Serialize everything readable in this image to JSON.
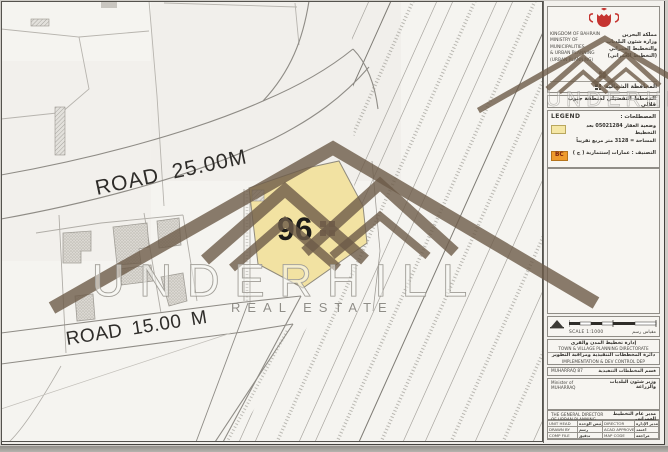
{
  "watermark": {
    "brand": "UNDERHILL",
    "tagline": "REAL ESTATE"
  },
  "map": {
    "plot_number": "96",
    "road_label_1": "ROAD 25.00M",
    "road_label_2": "ROAD 15.00 M"
  },
  "panel": {
    "header": {
      "en": [
        "KINGDOM OF BAHRAIN",
        "MINISTRY OF MUNICIPALITIES",
        "& URBAN PLANNING",
        "(URBAN PLANNING)"
      ],
      "ar": [
        "مملكة البحرين",
        "وزارة شئون البلديات",
        "والتخطيط العمراني",
        "(التخطيط العمراني)"
      ],
      "governorate": "المحافظة الشمالية"
    },
    "title": "المخطط التفصيلي لمنطقة جنوب قلالي",
    "legend": {
      "label_en": "LEGEND",
      "label_ar": "المصطلحات :",
      "plot_status_line1": "وضعية العقار 05021284 بعد التخطيط",
      "plot_status_line2": "المساحة = 3128 متر مربع تقريباً",
      "class_badge": "BC",
      "class_text": "التصنيف : عمارات إستثمارية ( ج )"
    },
    "scale": {
      "label": "SCALE  1:1000",
      "label_ar": "مقياس رسم"
    },
    "directorate": {
      "d1_ar": "إدارة تخطيط المدن والقرى",
      "d1_en": "TOWN & VILLAGE PLANNING DIRECTORATE",
      "d2_ar": "دائرة المخططات التنفيذية ومراقبة التطوير",
      "d2_en": "IMPLEMENTATION & DEV CONTROL DEP"
    },
    "ref": {
      "left": "MUHARRAQ 87",
      "right": "قسم المخططات التنفيذية"
    },
    "signatures": [
      {
        "en": "Minister of MUHARRAQ",
        "ar": "وزير شئون البلديات والزراعة"
      },
      {
        "en": "THE GENERAL DIRECTOR OF URBAN PLANNING",
        "ar": "مدير عام التخطيط العمراني"
      }
    ],
    "table": {
      "rows": [
        {
          "en1": "UNIT HEAD",
          "ar1": "رئيس الوحدة",
          "en2": "DIRECTOR",
          "ar2": "مدير الإدارة"
        },
        {
          "en1": "DRAWN BY",
          "ar1": "رسم",
          "en2": "ACAD APPROVED",
          "ar2": "اعتمد"
        },
        {
          "en1": "COMP FILE",
          "ar1": "تدقيق",
          "en2": "MAP CODE",
          "ar2": "مراجعة"
        }
      ]
    }
  },
  "colors": {
    "plot_fill": "#f2e2a2",
    "badge_orange": "#ef9b2d",
    "emblem_red": "#c53430",
    "watermark_brown": "#6d5b48"
  }
}
